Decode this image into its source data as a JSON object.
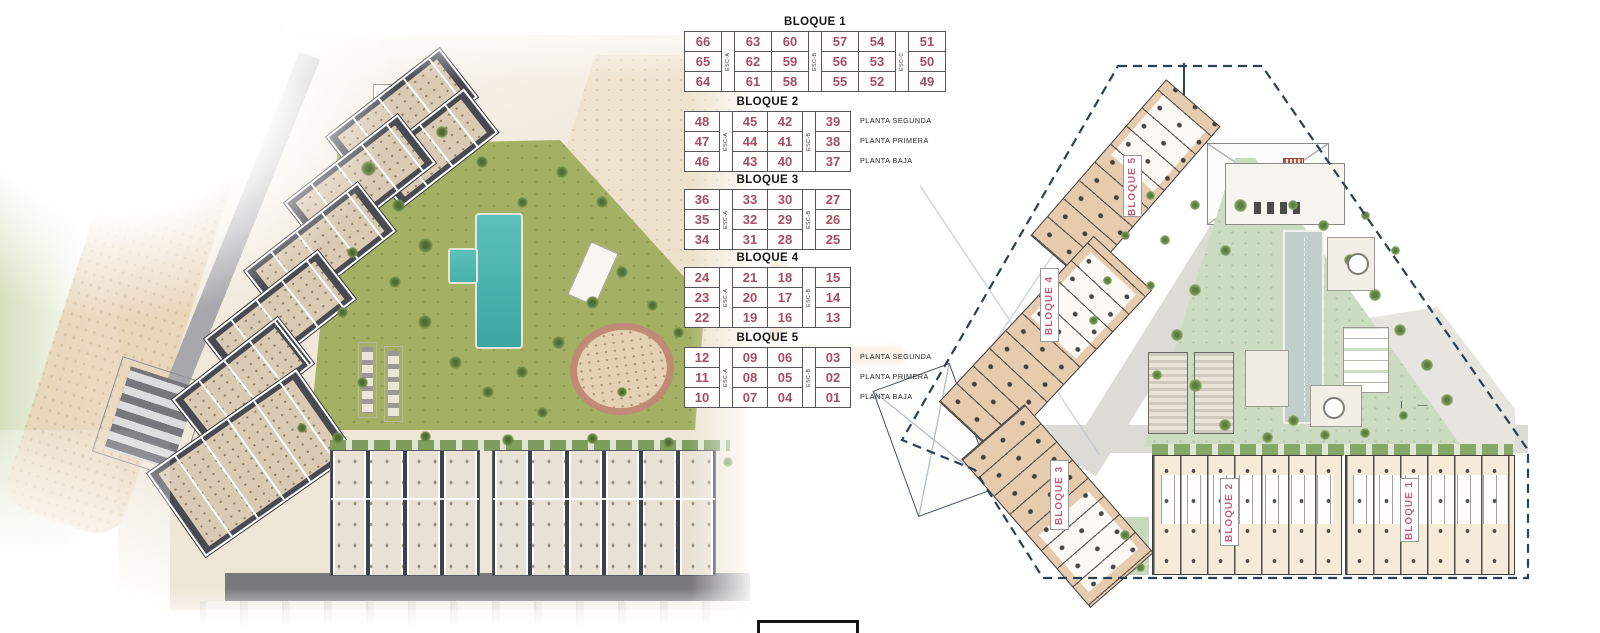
{
  "palette": {
    "unit_number": "#a34f65",
    "block_label_pink": "#c2607a",
    "table_line": "#55555a",
    "plan_boundary": "#2c4156",
    "pool_turquoise": "#3aa6a2",
    "lawn_green": "#a4b164",
    "plan_garden_green": "#ccdcc2",
    "building_tan": "#e7cbae"
  },
  "tables": [
    {
      "id": "bloque-1",
      "title": "BLOQUE 1",
      "columns": 6,
      "esc_labels": [
        "ESC-A",
        "ESC-B",
        "ESC-C"
      ],
      "rows": [
        [
          "66",
          "63",
          "60",
          "57",
          "54",
          "51"
        ],
        [
          "65",
          "62",
          "59",
          "56",
          "53",
          "50"
        ],
        [
          "64",
          "61",
          "58",
          "55",
          "52",
          "49"
        ]
      ],
      "floor_labels": []
    },
    {
      "id": "bloque-2",
      "title": "BLOQUE 2",
      "columns": 4,
      "esc_labels": [
        "ESC-A",
        "ESC-B"
      ],
      "rows": [
        [
          "48",
          "45",
          "42",
          "39"
        ],
        [
          "47",
          "44",
          "41",
          "38"
        ],
        [
          "46",
          "43",
          "40",
          "37"
        ]
      ],
      "floor_labels": [
        "PLANTA SEGUNDA",
        "PLANTA PRIMERA",
        "PLANTA BAJA"
      ]
    },
    {
      "id": "bloque-3",
      "title": "BLOQUE 3",
      "columns": 4,
      "esc_labels": [
        "ESC-A",
        "ESC-B"
      ],
      "rows": [
        [
          "36",
          "33",
          "30",
          "27"
        ],
        [
          "35",
          "32",
          "29",
          "26"
        ],
        [
          "34",
          "31",
          "28",
          "25"
        ]
      ],
      "floor_labels": []
    },
    {
      "id": "bloque-4",
      "title": "BLOQUE 4",
      "columns": 4,
      "esc_labels": [
        "ESC-A",
        "ESC-B"
      ],
      "rows": [
        [
          "24",
          "21",
          "18",
          "15"
        ],
        [
          "23",
          "20",
          "17",
          "14"
        ],
        [
          "22",
          "19",
          "16",
          "13"
        ]
      ],
      "floor_labels": []
    },
    {
      "id": "bloque-5",
      "title": "BLOQUE 5",
      "columns": 4,
      "esc_labels": [
        "ESC-A",
        "ESC-B"
      ],
      "rows": [
        [
          "12",
          "09",
          "06",
          "03"
        ],
        [
          "11",
          "08",
          "05",
          "02"
        ],
        [
          "10",
          "07",
          "04",
          "01"
        ]
      ],
      "floor_labels": [
        "PLANTA SEGUNDA",
        "PLANTA PRIMERA",
        "PLANTA BAJA"
      ]
    }
  ],
  "site_plan": {
    "block_labels": [
      "BLOQUE 5",
      "BLOQUE 4",
      "BLOQUE 3",
      "BLOQUE 2",
      "BLOQUE 1"
    ]
  }
}
